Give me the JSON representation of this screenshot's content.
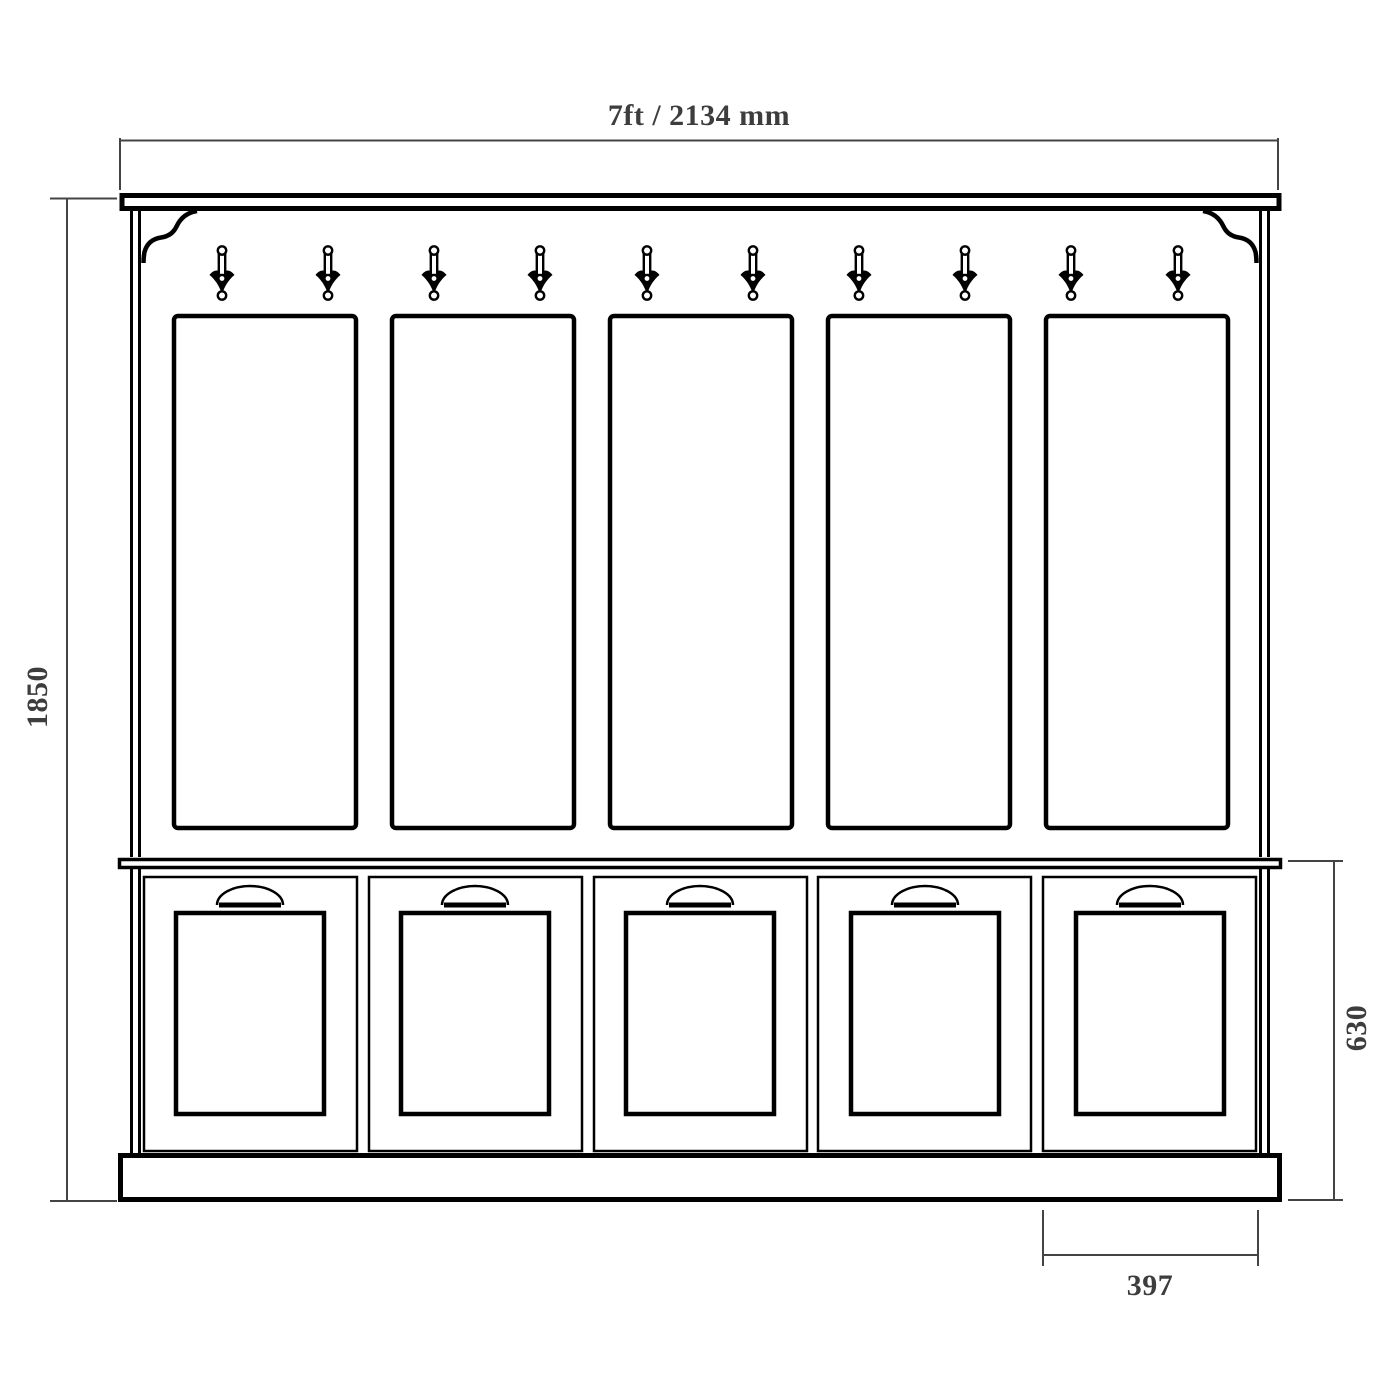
{
  "page": {
    "background": "#ffffff"
  },
  "drawing": {
    "type": "furniture-elevation-technical-drawing",
    "subject": "hallway coat rack with locker bench",
    "line_color": "#000000",
    "dimension_line_color": "#444444",
    "label_color": "#3d3d3d",
    "coat_hook_count": 10,
    "back_panel_count": 5,
    "locker_door_count": 5
  },
  "dimensions": {
    "overall_width": "7ft / 2134 mm",
    "overall_height": "1850",
    "lower_section_height": "630",
    "locker_width": "397"
  }
}
